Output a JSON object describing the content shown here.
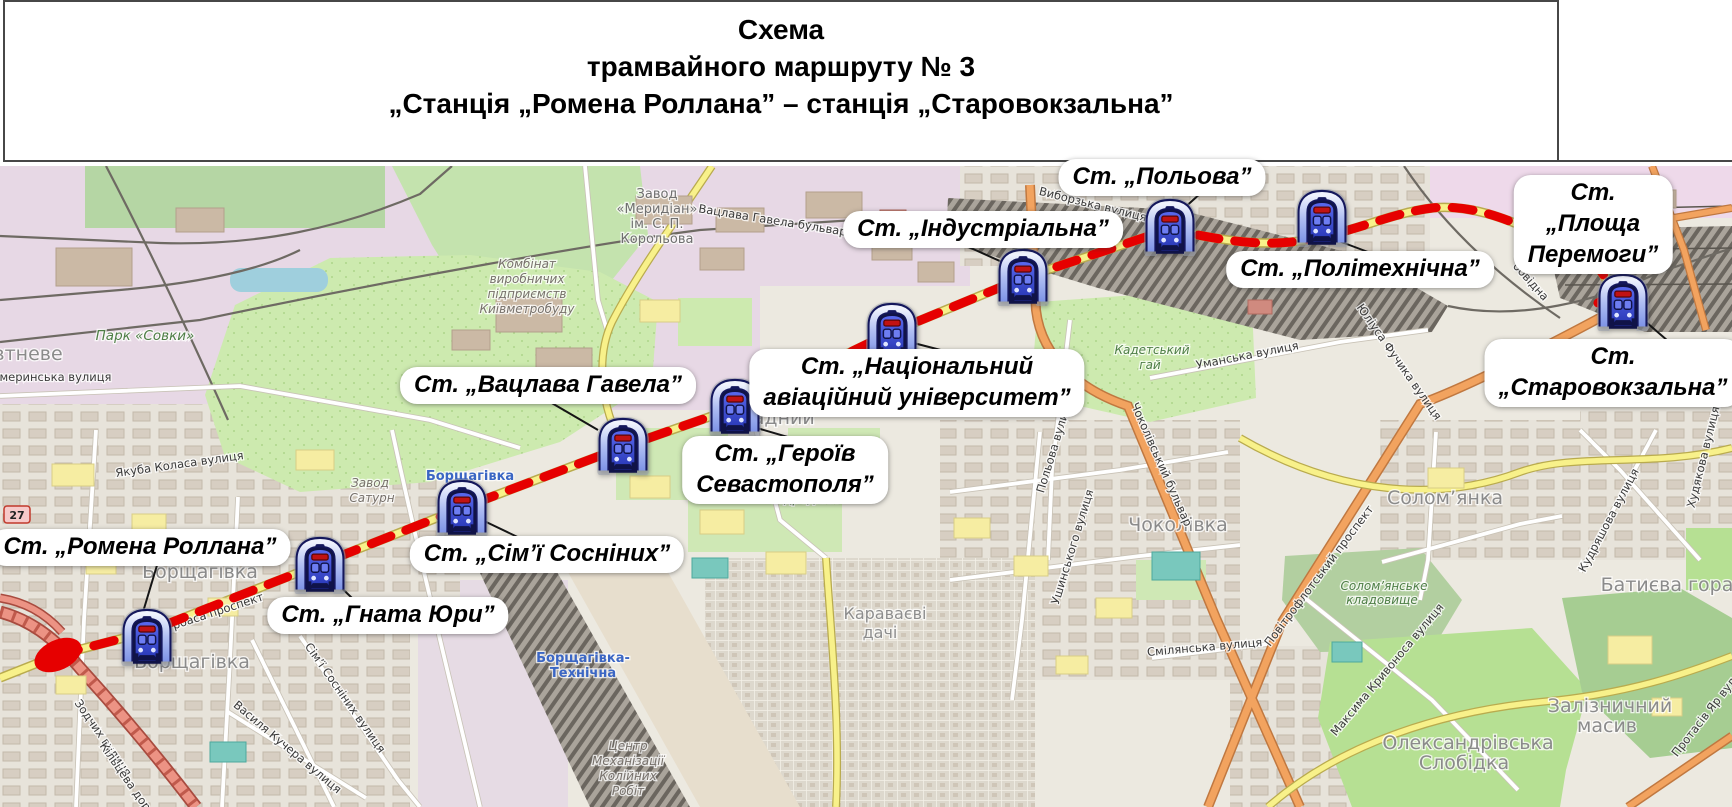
{
  "header": {
    "title_lines": [
      "Схема",
      "трамвайного маршруту № 3",
      "„Станція „Ромена Роллана” – станція „Старовокзальна”"
    ]
  },
  "route": {
    "number": "3",
    "color": "#e60000",
    "road_badge": "27"
  },
  "stations": [
    {
      "label": "Ст. „Ромена Роллана”"
    },
    {
      "label": "Ст. „Гната Юри”"
    },
    {
      "label": "Ст. „Сім’ї Сосніних”"
    },
    {
      "label": "Ст. „Вацлава Гавела”"
    },
    {
      "label": "Ст. „Героїв\nСевастополя”"
    },
    {
      "label": "Ст. „Національний\nавіаційний університет”"
    },
    {
      "label": "Ст. „Індустріальна”"
    },
    {
      "label": "Ст. „Польова”"
    },
    {
      "label": "Ст. „Політехнічна”"
    },
    {
      "label": "Ст. „Площа Перемоги”"
    },
    {
      "label": "Ст. „Старовокзальна”"
    }
  ],
  "map_labels": [
    {
      "text": "Парк «Совки»",
      "x": 145,
      "y": 340,
      "rot": 0,
      "cls": "green"
    },
    {
      "text": "втневе",
      "x": 28,
      "y": 360,
      "rot": 0,
      "cls": "district"
    },
    {
      "text": "Якуба Коласа вулиця",
      "x": 180,
      "y": 468,
      "rot": -8,
      "cls": "street"
    },
    {
      "text": "кмеринська вулиця",
      "x": 52,
      "y": 381,
      "rot": 0,
      "cls": "street"
    },
    {
      "text": "Завод",
      "x": 657,
      "y": 198,
      "rot": 0,
      "cls": "industrial"
    },
    {
      "text": "«Меридіан»",
      "x": 657,
      "y": 213,
      "rot": 0,
      "cls": "industrial"
    },
    {
      "text": "ім. С. П.",
      "x": 657,
      "y": 228,
      "rot": 0,
      "cls": "industrial"
    },
    {
      "text": "Корольова",
      "x": 657,
      "y": 243,
      "rot": 0,
      "cls": "industrial"
    },
    {
      "text": "Комбінат",
      "x": 527,
      "y": 268,
      "rot": 0,
      "cls": "industrial-sm"
    },
    {
      "text": "виробничих",
      "x": 527,
      "y": 283,
      "rot": 0,
      "cls": "industrial-sm"
    },
    {
      "text": "підприємств",
      "x": 527,
      "y": 298,
      "rot": 0,
      "cls": "industrial-sm"
    },
    {
      "text": "Київметробуду",
      "x": 527,
      "y": 313,
      "rot": 0,
      "cls": "industrial-sm"
    },
    {
      "text": "Вацлава Гавела бульвар",
      "x": 772,
      "y": 224,
      "rot": 9,
      "cls": "street"
    },
    {
      "text": "Виборзька вулиця",
      "x": 1092,
      "y": 208,
      "rot": 14,
      "cls": "street"
    },
    {
      "text": "Польова вулиця",
      "x": 1058,
      "y": 447,
      "rot": -73,
      "cls": "street"
    },
    {
      "text": "Кадетський",
      "x": 1152,
      "y": 354,
      "rot": 0,
      "cls": "green-sm"
    },
    {
      "text": "гай",
      "x": 1150,
      "y": 369,
      "rot": 0,
      "cls": "green-sm"
    },
    {
      "text": "Національний",
      "x": 872,
      "y": 386,
      "rot": 0,
      "cls": "poi"
    },
    {
      "text": "авіаційний",
      "x": 868,
      "y": 398,
      "rot": 0,
      "cls": "poi"
    },
    {
      "text": "університет",
      "x": 870,
      "y": 410,
      "rot": 0,
      "cls": "poi"
    },
    {
      "text": "Відрадний",
      "x": 806,
      "y": 503,
      "rot": 0,
      "cls": "green-sm"
    },
    {
      "text": "Відрадний",
      "x": 762,
      "y": 424,
      "rot": 0,
      "cls": "district"
    },
    {
      "text": "Борщагівка",
      "x": 200,
      "y": 578,
      "rot": 0,
      "cls": "district"
    },
    {
      "text": "Борщагівка",
      "x": 192,
      "y": 668,
      "rot": 0,
      "cls": "district"
    },
    {
      "text": "Борщагівка",
      "x": 470,
      "y": 480,
      "rot": 0,
      "cls": "blue"
    },
    {
      "text": "Завод",
      "x": 370,
      "y": 487,
      "rot": 0,
      "cls": "industrial-sm"
    },
    {
      "text": "Сатурн",
      "x": 372,
      "y": 502,
      "rot": 0,
      "cls": "industrial-sm"
    },
    {
      "text": "Борщагівка-",
      "x": 583,
      "y": 662,
      "rot": 0,
      "cls": "blue"
    },
    {
      "text": "Технічна",
      "x": 583,
      "y": 677,
      "rot": 0,
      "cls": "blue"
    },
    {
      "text": "Центр",
      "x": 628,
      "y": 750,
      "rot": 0,
      "cls": "industrial-sm"
    },
    {
      "text": "Механізації",
      "x": 628,
      "y": 765,
      "rot": 0,
      "cls": "industrial-sm"
    },
    {
      "text": "Колійних",
      "x": 628,
      "y": 780,
      "rot": 0,
      "cls": "industrial-sm"
    },
    {
      "text": "Робіт",
      "x": 628,
      "y": 795,
      "rot": 0,
      "cls": "industrial-sm"
    },
    {
      "text": "Караваєві",
      "x": 885,
      "y": 619,
      "rot": 0,
      "cls": "district-sm"
    },
    {
      "text": "дачі",
      "x": 880,
      "y": 638,
      "rot": 0,
      "cls": "district-sm"
    },
    {
      "text": "Чоколівка",
      "x": 1178,
      "y": 531,
      "rot": 0,
      "cls": "district"
    },
    {
      "text": "Чоколівський бульвар",
      "x": 1158,
      "y": 466,
      "rot": 66,
      "cls": "street"
    },
    {
      "text": "Ушинського вулиця",
      "x": 1076,
      "y": 548,
      "rot": -73,
      "cls": "street"
    },
    {
      "text": "Повітрофлотський проспект",
      "x": 1322,
      "y": 578,
      "rot": -53,
      "cls": "street"
    },
    {
      "text": "Максима Кривоноса вулиця",
      "x": 1390,
      "y": 672,
      "rot": -50,
      "cls": "street"
    },
    {
      "text": "Солом’янка",
      "x": 1445,
      "y": 504,
      "rot": 0,
      "cls": "district"
    },
    {
      "text": "Солом’янське",
      "x": 1384,
      "y": 590,
      "rot": 0,
      "cls": "green-sm"
    },
    {
      "text": "кладовище",
      "x": 1382,
      "y": 604,
      "rot": 0,
      "cls": "green-sm"
    },
    {
      "text": "Батиєва гора",
      "x": 1667,
      "y": 591,
      "rot": 0,
      "cls": "district"
    },
    {
      "text": "Кудряшова вулиця",
      "x": 1612,
      "y": 522,
      "rot": -62,
      "cls": "street"
    },
    {
      "text": "Залізничний",
      "x": 1610,
      "y": 712,
      "rot": 0,
      "cls": "district"
    },
    {
      "text": "масив",
      "x": 1607,
      "y": 732,
      "rot": 0,
      "cls": "district"
    },
    {
      "text": "Олександрівська",
      "x": 1468,
      "y": 749,
      "rot": 0,
      "cls": "district"
    },
    {
      "text": "Слобідка",
      "x": 1464,
      "y": 769,
      "rot": 0,
      "cls": "district"
    },
    {
      "text": "Протасів Яр вул.",
      "x": 1708,
      "y": 718,
      "rot": -52,
      "cls": "street"
    },
    {
      "text": "Юліуса Фучика вулиця",
      "x": 1396,
      "y": 364,
      "rot": 55,
      "cls": "street"
    },
    {
      "text": "Уманська вулиця",
      "x": 1248,
      "y": 359,
      "rot": -11,
      "cls": "street"
    },
    {
      "text": "Худякова вулиця",
      "x": 1707,
      "y": 458,
      "rot": -76,
      "cls": "street"
    },
    {
      "text": "Київ-Пасажирський",
      "x": 1620,
      "y": 389,
      "rot": 0,
      "cls": "blue"
    },
    {
      "text": "Зодчих вулиця",
      "x": 100,
      "y": 740,
      "rot": 55,
      "cls": "street"
    },
    {
      "text": "Кільцева дорога",
      "x": 128,
      "y": 787,
      "rot": 55,
      "cls": "street"
    },
    {
      "text": "Василя Кучера вулиця",
      "x": 285,
      "y": 750,
      "rot": 40,
      "cls": "street"
    },
    {
      "text": "Сім’ї Сосніних вулиця",
      "x": 342,
      "y": 700,
      "rot": 55,
      "cls": "street"
    },
    {
      "text": "Курбаса проспект",
      "x": 212,
      "y": 617,
      "rot": -18,
      "cls": "street"
    },
    {
      "text": "обвідна",
      "x": 1528,
      "y": 284,
      "rot": 48,
      "cls": "street"
    },
    {
      "text": "Смілянська вулиця",
      "x": 1205,
      "y": 651,
      "rot": -5,
      "cls": "street"
    }
  ]
}
